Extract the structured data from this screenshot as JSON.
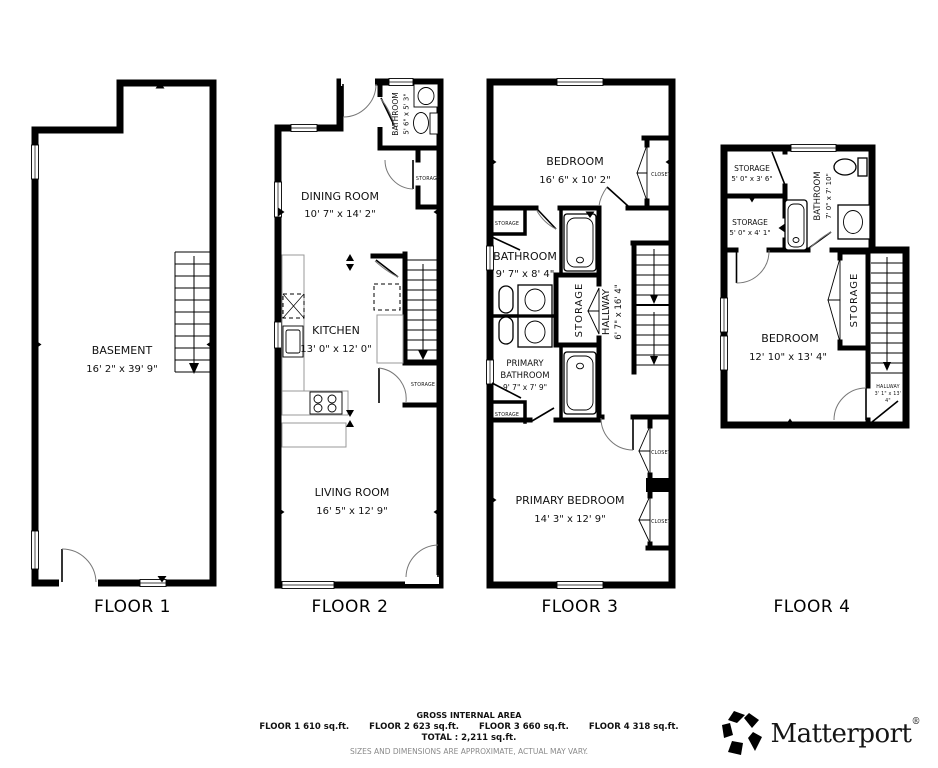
{
  "colors": {
    "walls": "#000000",
    "text": "#111111",
    "disclaimer_gray": "#8a8a8a"
  },
  "floors": {
    "f1": {
      "label": "FLOOR 1",
      "basement": {
        "name": "BASEMENT",
        "dims": "16' 2\" x 39' 9\""
      }
    },
    "f2": {
      "label": "FLOOR 2",
      "bathroom": {
        "name": "BATHROOM",
        "dims": "5' 6\" x 5' 3\""
      },
      "dining": {
        "name": "DINING ROOM",
        "dims": "10' 7\" x 14' 2\""
      },
      "kitchen": {
        "name": "KITCHEN",
        "dims": "13' 0\" x 12' 0\""
      },
      "living": {
        "name": "LIVING ROOM",
        "dims": "16' 5\" x 12' 9\""
      },
      "storage_tag": "STORAGE"
    },
    "f3": {
      "label": "FLOOR 3",
      "bedroom": {
        "name": "BEDROOM",
        "dims": "16' 6\" x 10' 2\""
      },
      "bathroom": {
        "name": "BATHROOM",
        "dims": "9' 7\" x 8' 4\""
      },
      "hallway": {
        "name": "HALLWAY",
        "dims": "6' 7\" x 16' 4\""
      },
      "primary_bathroom": {
        "lines": [
          "PRIMARY",
          "BATHROOM",
          "9' 7\" x 7' 9\""
        ]
      },
      "primary_bedroom": {
        "name": "PRIMARY BEDROOM",
        "dims": "14' 3\" x 12' 9\""
      },
      "storage_mid": "STORAGE",
      "storage_tag": "STORAGE",
      "closet_tag": "CLOSET"
    },
    "f4": {
      "label": "FLOOR 4",
      "storage1": {
        "name": "STORAGE",
        "dims": "5' 0\" x 3' 6\""
      },
      "storage2": {
        "name": "STORAGE",
        "dims": "5' 0\" x 4' 1\""
      },
      "bathroom": {
        "name": "BATHROOM",
        "dims": "7' 0\" x 7' 10\""
      },
      "bedroom": {
        "name": "BEDROOM",
        "dims": "12' 10\" x 13' 4\""
      },
      "storage_mid": "STORAGE",
      "hallway": {
        "lines": [
          "HALLWAY",
          "3' 1\" x 13'",
          "4\""
        ]
      }
    }
  },
  "footer": {
    "title": "GROSS INTERNAL AREA",
    "floor_areas": [
      "FLOOR 1 610 sq.ft.",
      "FLOOR 2 623 sq.ft.",
      "FLOOR 3 660 sq.ft.",
      "FLOOR 4 318 sq.ft."
    ],
    "total": "TOTAL :  2,211 sq.ft.",
    "disclaimer": "SIZES AND DIMENSIONS ARE APPROXIMATE, ACTUAL MAY VARY."
  },
  "brand": {
    "wordmark": "Matterport",
    "registered": "®",
    "icon": "matterport-pinwheel-icon"
  }
}
